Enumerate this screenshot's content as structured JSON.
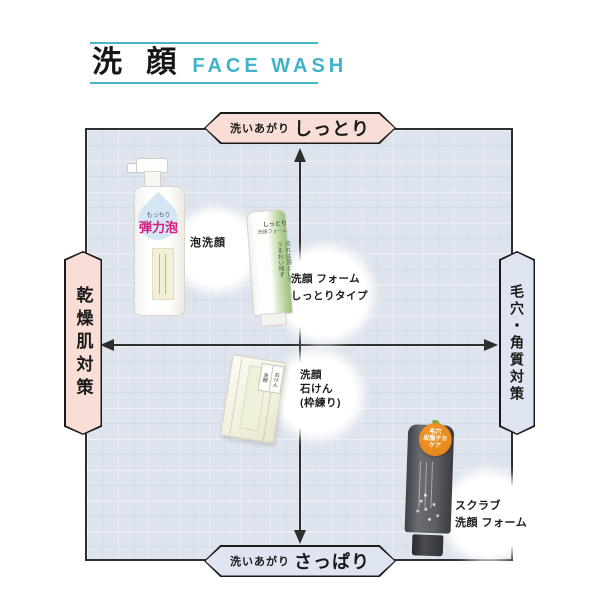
{
  "header": {
    "title_jp": "洗 顔",
    "title_en": "FACE WASH"
  },
  "quadrant": {
    "top_axis": {
      "prefix": "洗いあがり",
      "label": "しっとり"
    },
    "bottom_axis": {
      "prefix": "洗いあがり",
      "label": "さっぱり"
    },
    "left_axis": {
      "label": "乾燥肌対策"
    },
    "right_axis": {
      "label": "毛穴・角質対策"
    }
  },
  "products": {
    "foam_wash": {
      "callout": "泡洗顔",
      "pack_text_small": "もっちり",
      "pack_text_big": "弾力泡"
    },
    "foam_moist": {
      "callout_lines": [
        "洗顔 フォーム",
        "しっとりタイプ"
      ],
      "pack_top_lines": [
        "しっとり",
        "洗顔フォーム"
      ],
      "pack_stripe_lines": [
        "汚れは落として",
        "うるおい残す"
      ]
    },
    "soap": {
      "callout_lines": [
        "洗顔",
        "石けん",
        "(枠練り)"
      ],
      "pack_tabs": [
        "洗顔",
        "石けん"
      ]
    },
    "scrub": {
      "callout_lines": [
        "スクラブ",
        "洗顔 フォーム"
      ],
      "badge_lines": [
        "毛穴",
        "皮脂テカ",
        "ケア"
      ]
    }
  },
  "colors": {
    "accent_teal": "#3fb3c7",
    "moist_pink": "#f9ded7",
    "fresh_blue": "#dee4f1",
    "grid_bg": "#dde4ed",
    "axis_black": "#2e2e2e",
    "foam_magenta": "#d81b7f",
    "tube_green": "#afd093",
    "scrub_orange": "#e8871e"
  }
}
